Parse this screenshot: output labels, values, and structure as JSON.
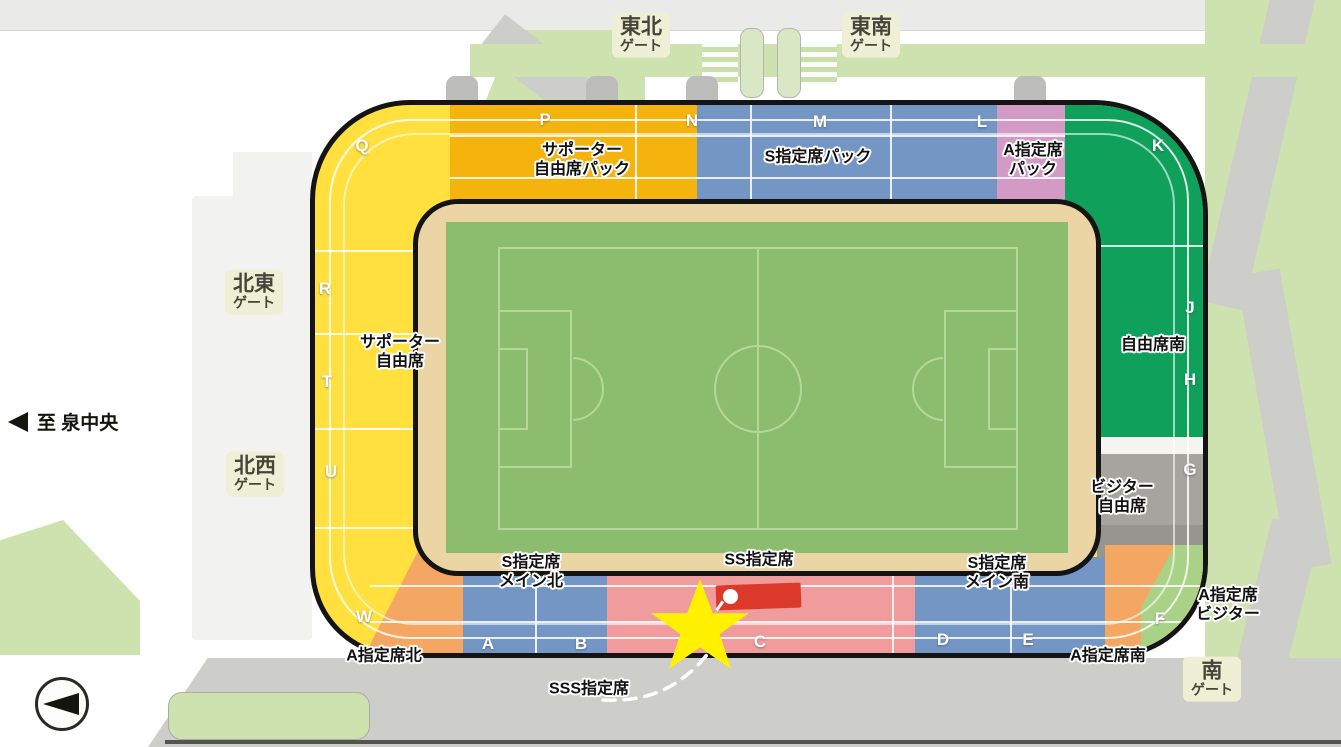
{
  "colors": {
    "outline": "#141414",
    "gold": "#F5B40D",
    "yellow": "#FFE03F",
    "blue": "#7396C5",
    "pink": "#D49AC6",
    "green": "#0FA05C",
    "pale_green": "#A9D287",
    "section_gray": "#A6A49E",
    "section_gray_dark": "#97958F",
    "salmon": "#F19C9C",
    "red": "#DB3A2A",
    "orange": "#F4A763",
    "star": "#FFF100",
    "field": "#8CBC6E",
    "pitch_line": "#B6D897",
    "tan": "#ECD5A4",
    "park": "#CDE2AE",
    "road": "#CDCDCA",
    "plaza": "#F2F2F0",
    "gate_bg": "#EEF0D5",
    "gate_text": "#45453A",
    "white_band": "#F4F4F2"
  },
  "gates": {
    "northeast_top": {
      "line1": "東北",
      "line2": "ゲート"
    },
    "southeast_top": {
      "line1": "東南",
      "line2": "ゲート"
    },
    "northeast_left": {
      "line1": "北東",
      "line2": "ゲート"
    },
    "northwest_left": {
      "line1": "北西",
      "line2": "ゲート"
    },
    "south": {
      "line1": "南",
      "line2": "ゲート"
    }
  },
  "direction_sign": {
    "text": "至 泉中央"
  },
  "section_labels": {
    "supporter_free_back": {
      "line1": "サポーター",
      "line2": "自由席パック"
    },
    "s_reserved_back": {
      "line1": "S指定席パック"
    },
    "a_reserved_back": {
      "line1": "A指定席",
      "line2": "パック"
    },
    "supporter_free": {
      "line1": "サポーター",
      "line2": "自由席"
    },
    "free_seat_south": {
      "line1": "自由席南"
    },
    "visitor_free": {
      "line1": "ビジター",
      "line2": "自由席"
    },
    "s_reserved_main_north": {
      "line1": "S指定席",
      "line2": "メイン北"
    },
    "ss_reserved": {
      "line1": "SS指定席"
    },
    "s_reserved_main_south": {
      "line1": "S指定席",
      "line2": "メイン南"
    },
    "a_reserved_north": {
      "line1": "A指定席北"
    },
    "a_reserved_south": {
      "line1": "A指定席南"
    },
    "a_reserved_visitor": {
      "line1": "A指定席",
      "line2": "ビジター"
    },
    "sss_reserved": {
      "line1": "SSS指定席"
    }
  },
  "blocks": {
    "q": "Q",
    "p": "P",
    "n": "N",
    "m": "M",
    "l": "L",
    "k": "K",
    "r": "R",
    "t": "T",
    "u": "U",
    "w": "W",
    "j": "J",
    "h": "H",
    "g": "G",
    "f": "F",
    "a": "A",
    "b": "B",
    "c": "C",
    "d": "D",
    "e": "E"
  }
}
